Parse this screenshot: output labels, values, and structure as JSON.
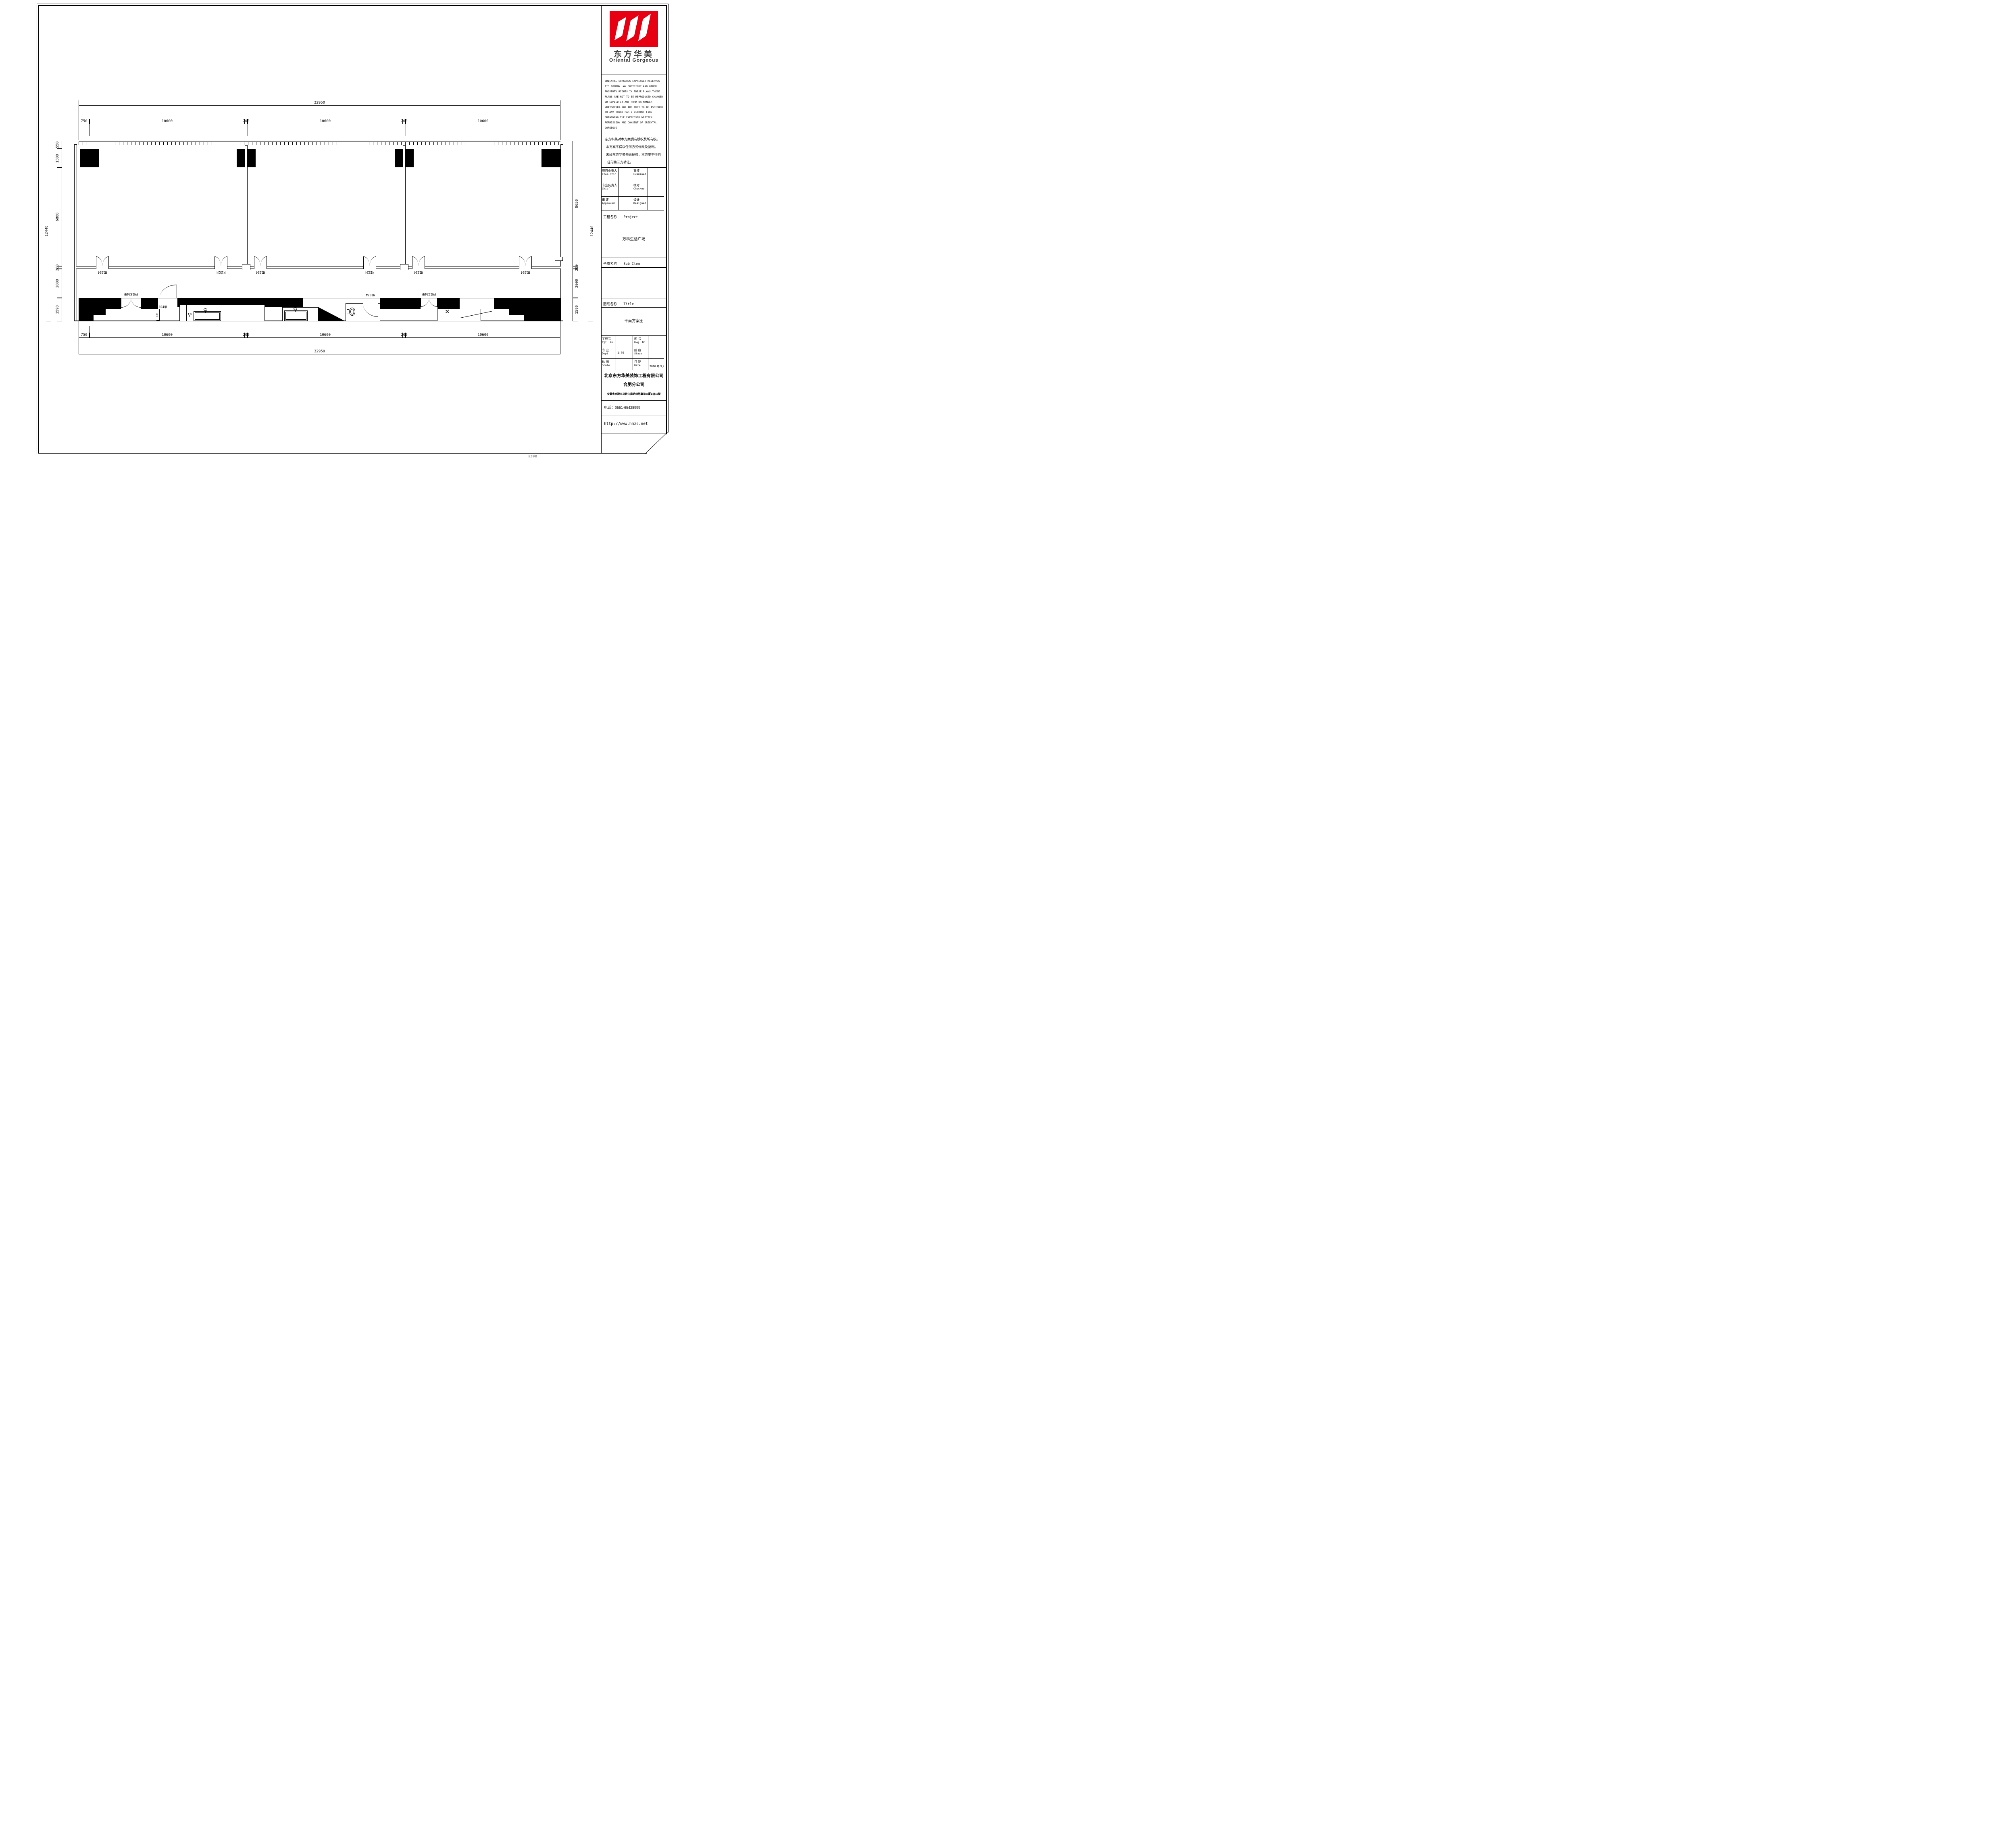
{
  "logo": {
    "cn": "东方华美",
    "en": "Oriental Gorgeous"
  },
  "copyright": {
    "en": [
      "ORIENTAL GORGEOUS EXPRESSLY RESERVES",
      "ITS COMMON LAW COPYRIGHT AND OTHER",
      "PROPERTY RIGHTS IN THESE PLANS.THESE",
      "PLANS ARE NOT TO BE REPRODUCED CHANGED",
      "OR COPIED IN ANY FORM OR MANNER",
      "WHATSOEVER.NOR ARE THEY TO BE ASSIGHED",
      "TO ANY THIRD PARTY WITHOUT FIRST",
      "OBTAINING THE EXPRESSED WRITTEN",
      "PERMISSION AND CONSENT OF ORIENTAL",
      "GORGEOUS"
    ],
    "cn": [
      "东方华美对本方案拥有版权及所有权。",
      "本方案不得以任何方式修改及复制。",
      "未经东方华美书面授权，本方案不得向",
      "任何第三方转让。"
    ]
  },
  "personnel": {
    "rows": [
      {
        "l1": "项目负责人",
        "l1en": "Item.Prin",
        "v1": "",
        "l2": "审核",
        "l2en": "Examined",
        "v2": ""
      },
      {
        "l1": "专业负责人",
        "l1en": "Chief",
        "v1": "",
        "l2": "校对",
        "l2en": "Checked",
        "v2": ""
      },
      {
        "l1": "审 定",
        "l1en": "Approved",
        "v1": "",
        "l2": "设计",
        "l2en": "Designed",
        "v2": ""
      }
    ]
  },
  "project": {
    "label_cn": "工程名称",
    "label_en": "Project",
    "value": "万科生活广场"
  },
  "sub_item": {
    "label_cn": "子项名称",
    "label_en": "Sub Item",
    "value": ""
  },
  "sheet_title": {
    "label_cn": "图纸名称",
    "label_en": "Title",
    "value": "平面方案图"
  },
  "info": {
    "rows": [
      {
        "l1": "工程号",
        "l1en": "Pjt .No.",
        "v1": "",
        "l2": "图 号",
        "l2en": "Dwg. No.",
        "v2": ""
      },
      {
        "l1": "专 业",
        "l1en": "Dept.",
        "v1": "1:70",
        "l2": "阶 段",
        "l2en": "Stage",
        "v2": ""
      },
      {
        "l1": "比 例",
        "l1en": "Scale",
        "v1": "",
        "l2": "日 期",
        "l2en": "Date",
        "v2": "2016 年 3  月"
      }
    ]
  },
  "company": {
    "name": "北京东方华美装饰工程有限公司",
    "branch": "合肥分公司",
    "address": "安徽省合肥市马鞍山南路绿地赢海大厦B座19楼",
    "phone": "电话：0551-65428999",
    "website": "http://www.hmzs.net"
  },
  "plan": {
    "dim_total": "32950",
    "dim_total_v": "12440",
    "h_chain": [
      "750",
      "10600",
      "200",
      "10600",
      "200",
      "10600"
    ],
    "left_chain": [
      "550",
      "1300",
      "6800",
      "200",
      "2000",
      "1590"
    ],
    "right_chain": [
      "8650",
      "200",
      "2000",
      "1590"
    ],
    "door_m1524": "M1524",
    "door_fm1524": "FM1524甲",
    "door_fm1024": "FM1024甲",
    "door_m1024": "M1024",
    "door_fm1224": "FM1224甲",
    "dim_small": "738"
  },
  "footer_mark": "东方华美"
}
